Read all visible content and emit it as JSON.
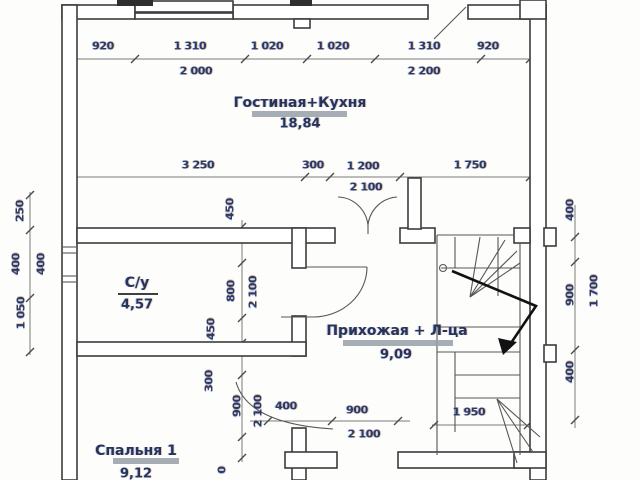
{
  "plan": {
    "rooms": [
      {
        "name": "Гостиная+Кухня",
        "area": "18,84"
      },
      {
        "name": "С/у",
        "area": "4,57"
      },
      {
        "name": "Прихожая + Л-ца",
        "area": "9,09"
      },
      {
        "name": "Спальня 1",
        "area": "9,12"
      }
    ],
    "dims": {
      "top": [
        "920",
        "1 310",
        "1 020",
        "1 020",
        "1 310",
        "920"
      ],
      "top2": [
        "2 000",
        "2 200"
      ],
      "mid": [
        "3 250",
        "300",
        "1 200",
        "1 750"
      ],
      "mid2": [
        "2 100"
      ],
      "left": [
        "250",
        "400",
        "400",
        "1 050"
      ],
      "center": [
        "450",
        "800",
        "2 100",
        "450",
        "300",
        "900",
        "2 100",
        "0"
      ],
      "right": [
        "400",
        "900",
        "1 700",
        "400"
      ],
      "bottom": [
        "400",
        "900",
        "2 100",
        "1 950"
      ]
    }
  }
}
